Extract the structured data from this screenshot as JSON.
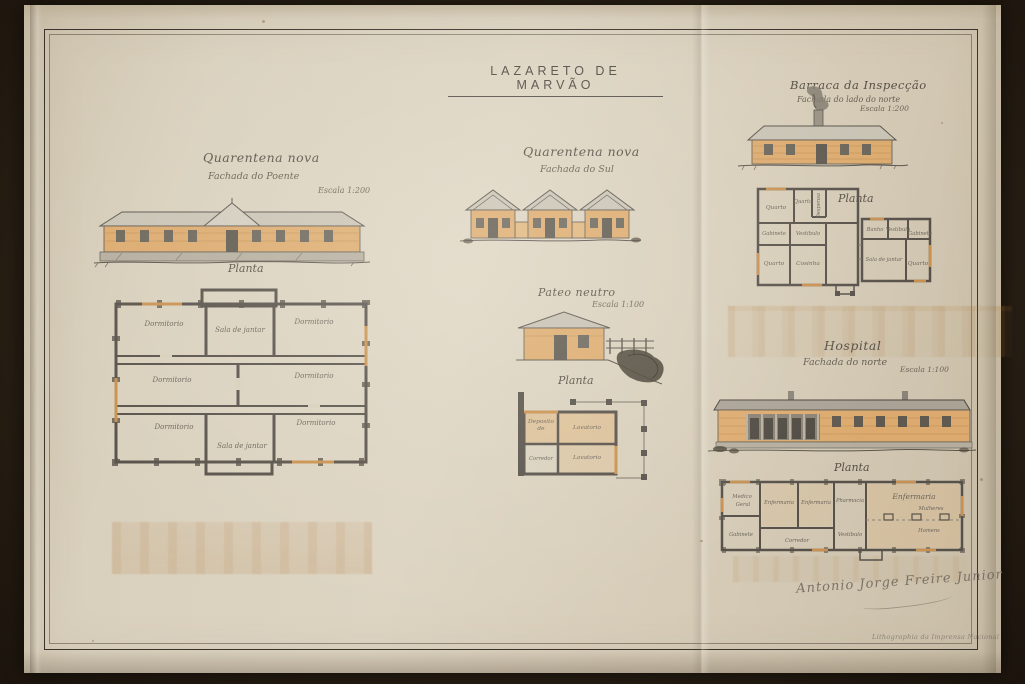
{
  "sheet": {
    "title": "LAZARETO DE MARVÃO",
    "signature": "Antonio Jorge Freire Junior",
    "imprint": "Lithographia da Imprensa Nacional"
  },
  "quarentena_poente": {
    "title": "Quarentena nova",
    "subtitle": "Fachada do Poente",
    "scale": "Escala 1:200",
    "plan_label": "Planta",
    "rooms": {
      "dormitorio": "Dormitorio",
      "sala_de_jantar": "Sala de jantar"
    }
  },
  "quarentena_sul": {
    "title": "Quarentena nova",
    "subtitle": "Fachada do Sul"
  },
  "pateo_neutro": {
    "title": "Pateo neutro",
    "scale": "Escala 1:100",
    "plan_label": "Planta",
    "rooms": {
      "deposito": "Deposito de",
      "lavatorio_1": "Lavatorio",
      "corredor": "Corredor",
      "lavatorio_2": "Lavatorio"
    }
  },
  "barraca": {
    "title": "Barraca da Inspecção",
    "subtitle": "Fachada do lado do norte",
    "scale": "Escala 1:200",
    "plan_label": "Planta",
    "rooms": {
      "quarto_1": "Quarto",
      "quarto_2": "Quarto",
      "despensa": "Despensa",
      "gabinete_1": "Gabinete",
      "vestibulo_1": "Vestibulo",
      "quarto_3": "Quarto",
      "cosinha": "Cosinha",
      "banho": "Banho",
      "vestibulo_2": "Vestibulo",
      "gabinete_2": "Gabinete",
      "sala_de_jantar": "Sala de jantar",
      "quarto_4": "Quarto"
    }
  },
  "hospital": {
    "title": "Hospital",
    "subtitle": "Fachada do norte",
    "scale": "Escala 1:100",
    "plan_label": "Planta",
    "rooms": {
      "medico_1": "Medico",
      "medico_2": "Geral",
      "gabinete": "Gabinete",
      "enfermaria_1": "Enfermaria",
      "enfermaria_2": "Enfermaria",
      "pharmacia": "Pharmacia",
      "vestibulo": "Vestibulo",
      "corredor": "Corredor",
      "enfermaria_3": "Enfermaria",
      "mulheres": "Mulheres",
      "homens": "Homens"
    }
  },
  "colors": {
    "photo_background": "#2b2116",
    "paper": "#d8cebb",
    "ink": "#4a443c",
    "wall_wash": "#dcaa6e",
    "roof": "#c9c3b4"
  }
}
